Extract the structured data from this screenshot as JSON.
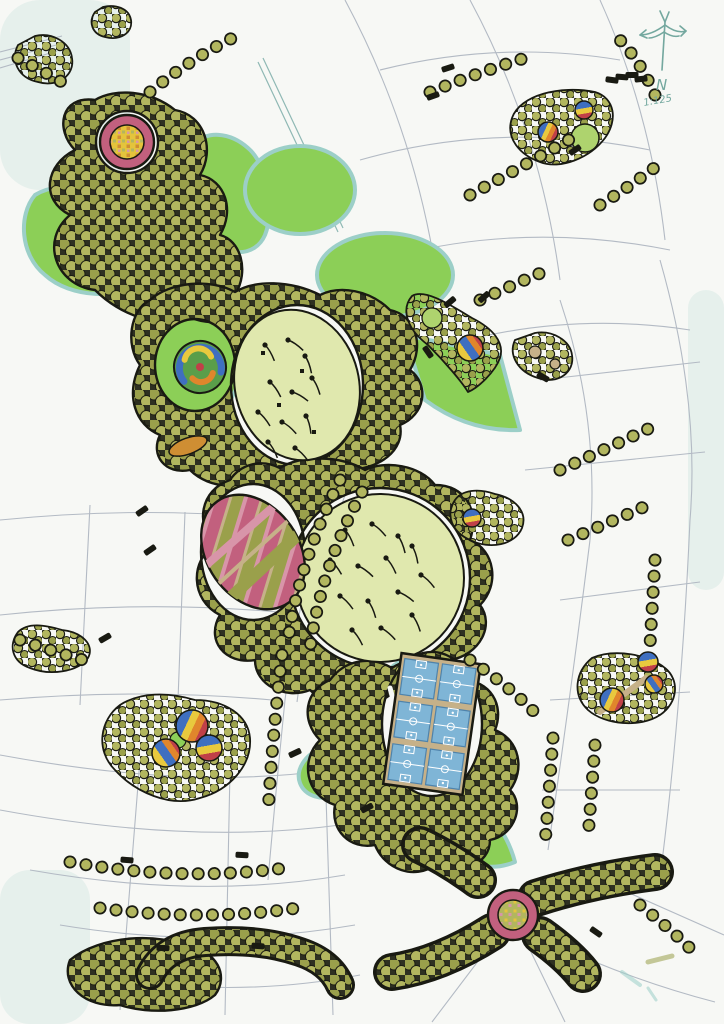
{
  "compass": {
    "north_label": "N",
    "scale_label": "1:125"
  },
  "palette": {
    "paper": "#f7f8f5",
    "street": "#b3bac4",
    "street-teal": "#8fb8b4",
    "ink": "#191a12",
    "ink-soft": "#2e3021",
    "canopy": "#9aa04b",
    "canopy-light": "#b2b65f",
    "lawn-bright": "#8ccf57",
    "lawn-mid": "#aed36e",
    "shadow-teal": "#9ccfc8",
    "meadow": "#e0e8ae",
    "pink": "#c2607e",
    "pink-light": "#d895a9",
    "mosaic-yellow": "#e4c43c",
    "mosaic-orange": "#cf8e33",
    "court-blue": "#7fb5d6",
    "court-line": "#ffffff",
    "court-dark": "#4f83ab",
    "tan": "#c6b189",
    "ball-blue": "#3f6fc0",
    "ball-yellow": "#e8c93e",
    "ball-orange": "#e0862c",
    "ball-red": "#c04048",
    "swirl-green": "#5a9e4a",
    "compass": "#74a89f"
  }
}
